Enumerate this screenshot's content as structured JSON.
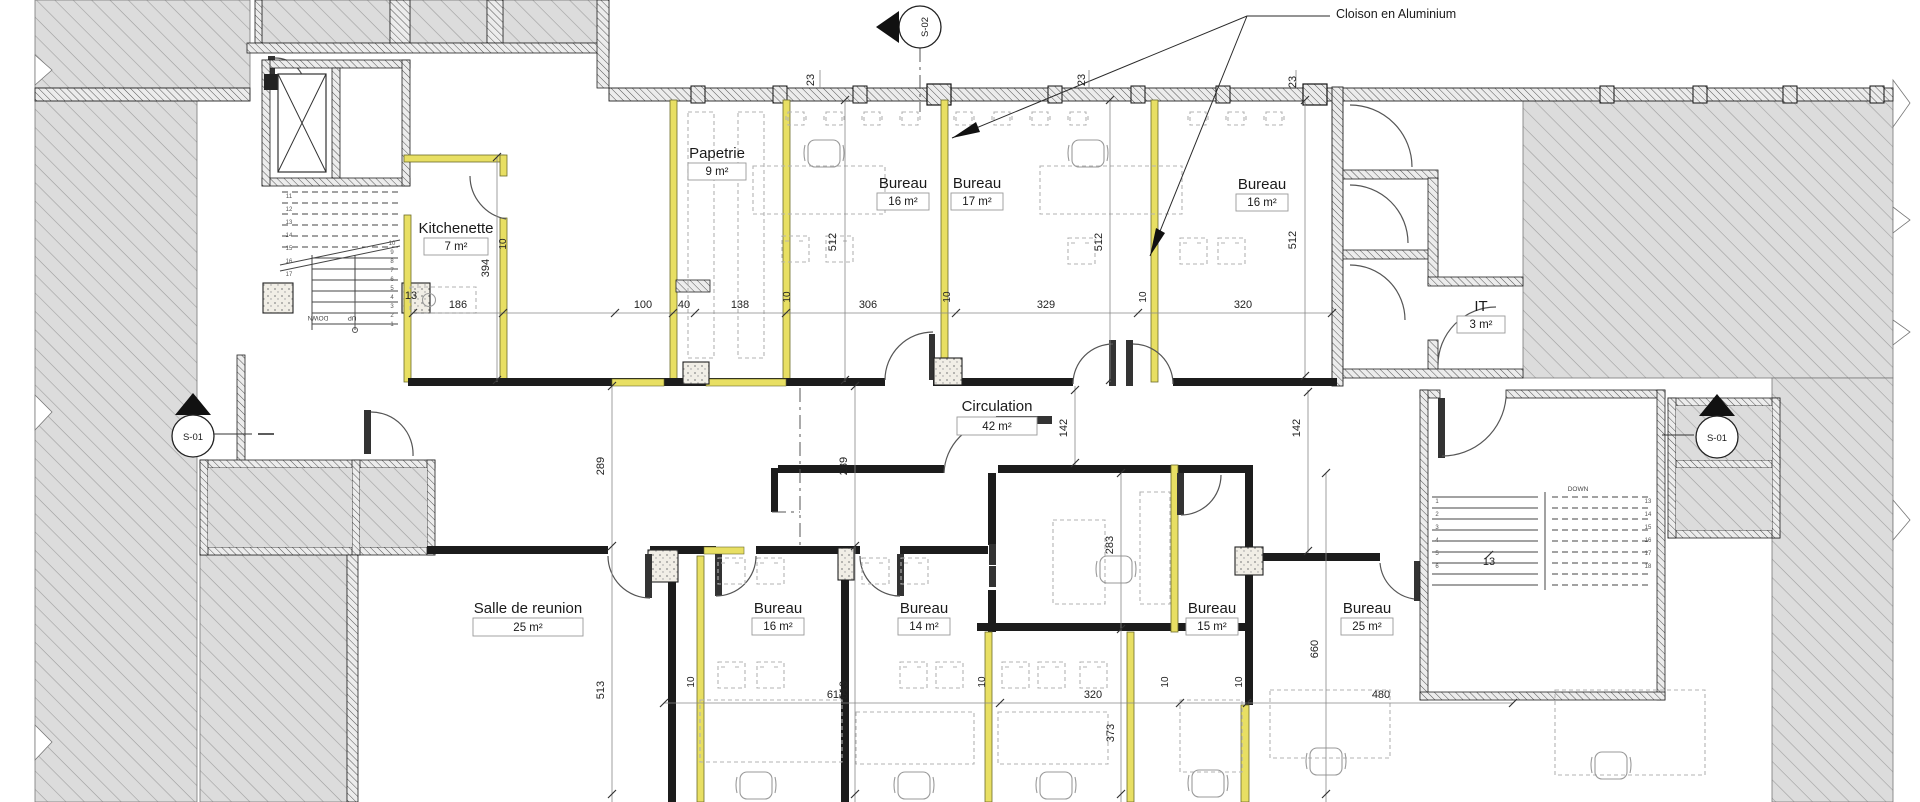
{
  "annotation": {
    "text": "Cloison en Aluminium"
  },
  "section_markers": {
    "top": "S-02",
    "left": "S-01",
    "right": "S-01"
  },
  "rooms": [
    {
      "name": "Papetrie",
      "area": "9 m²"
    },
    {
      "name": "Kitchenette",
      "area": "7 m²"
    },
    {
      "name": "Bureau",
      "area": "16 m²"
    },
    {
      "name": "Bureau",
      "area": "17 m²"
    },
    {
      "name": "Bureau",
      "area": "16 m²"
    },
    {
      "name": "IT",
      "area": "3 m²"
    },
    {
      "name": "Circulation",
      "area": "42 m²"
    },
    {
      "name": "Salle de reunion",
      "area": "25 m²"
    },
    {
      "name": "Bureau",
      "area": "16 m²"
    },
    {
      "name": "Bureau",
      "area": "14 m²"
    },
    {
      "name": "Bureau",
      "area": "15 m²"
    },
    {
      "name": "Bureau",
      "area": "25 m²"
    }
  ],
  "dims": [
    "23",
    "23",
    "23",
    "512",
    "512",
    "512",
    "394",
    "13",
    "186",
    "100",
    "40",
    "138",
    "306",
    "329",
    "320",
    "10",
    "10",
    "10",
    "10",
    "142",
    "142",
    "289",
    "289",
    "283",
    "513",
    "513",
    "612",
    "320",
    "480",
    "10",
    "10",
    "10",
    "10",
    "660",
    "373",
    "13"
  ],
  "stairs": {
    "left": {
      "down": "DOWN",
      "up": "UP",
      "treads_right": [
        "10",
        "9",
        "8",
        "7",
        "6",
        "5",
        "4",
        "3",
        "2",
        "1"
      ],
      "treads_left": [
        "11",
        "12",
        "13",
        "14",
        "15",
        "16",
        "17",
        "18",
        "19"
      ]
    },
    "right": {
      "down": "DOWN",
      "treads_left": [
        "1",
        "2",
        "3",
        "4",
        "5",
        "6"
      ],
      "treads_right": [
        "13",
        "14",
        "15",
        "16",
        "17",
        "18"
      ]
    }
  },
  "colors": {
    "partition": "#e8df63",
    "hatch_line": "#9a9a9a",
    "wall": "#1c1c1c"
  }
}
